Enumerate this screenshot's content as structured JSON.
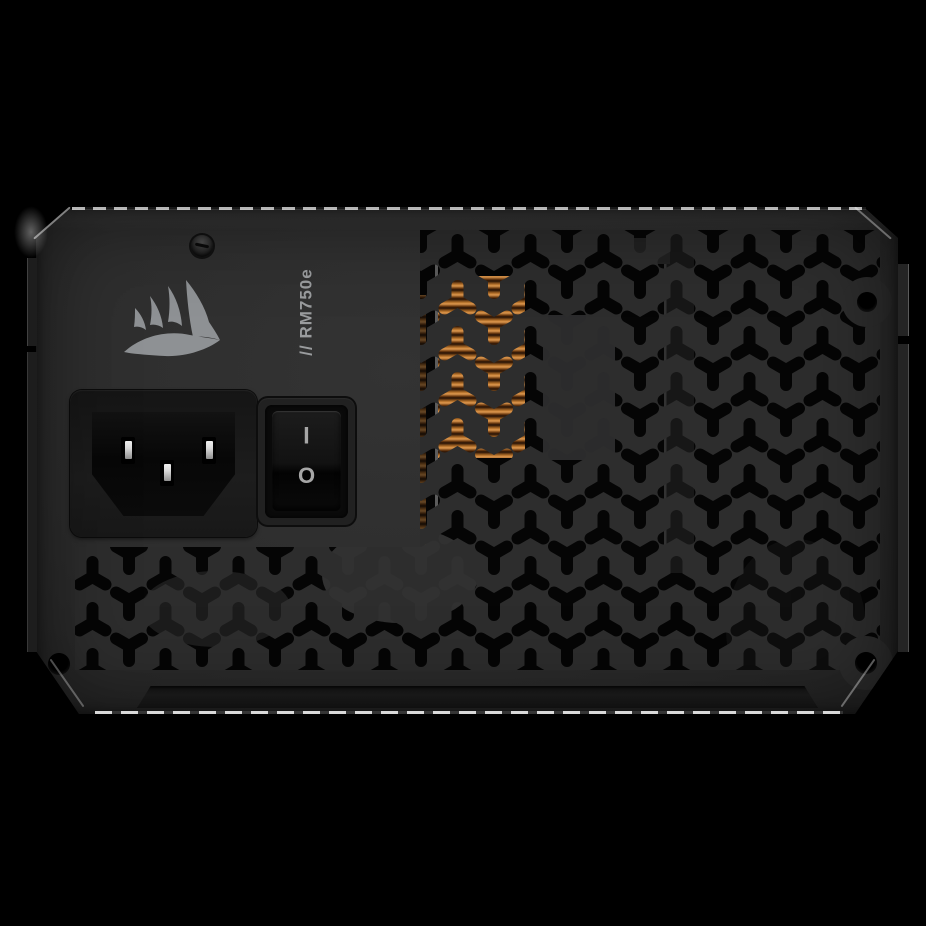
{
  "scene": {
    "subject": "Rear panel of a Corsair RM750e power supply unit",
    "background": "solid black studio backdrop with rim lighting on chassis edges"
  },
  "device": {
    "model_label": "// RM750e",
    "brand_icon": "corsair-sails-logo-icon",
    "power_switch": {
      "on_symbol": "I",
      "off_symbol": "O"
    },
    "ac_inlet": {
      "pins": 3
    },
    "vent_pattern": "tessellated Y-shaped perforations",
    "visible_internals": [
      "copper heatsink fins",
      "gray component block",
      "vertical heatsink bar"
    ],
    "screw_top_count": 1,
    "corner_screw_holes": 3
  },
  "colors": {
    "bg": "#000000",
    "face": "#2d2d2d",
    "face-deep": "#242424",
    "hole": "#050505",
    "rim": "#eeeeee",
    "logo": "#8e9194",
    "label": "#9a9c9e",
    "copper-hi": "#e09a50",
    "copper-mid": "#b06d28",
    "copper-dark": "#241004",
    "pin-metal": "#d8d8d8",
    "mark": "#a6a6a6",
    "strip": "#1e1e1e",
    "side": "#1d1d1d",
    "internal-gray": "#2b2b2c"
  }
}
